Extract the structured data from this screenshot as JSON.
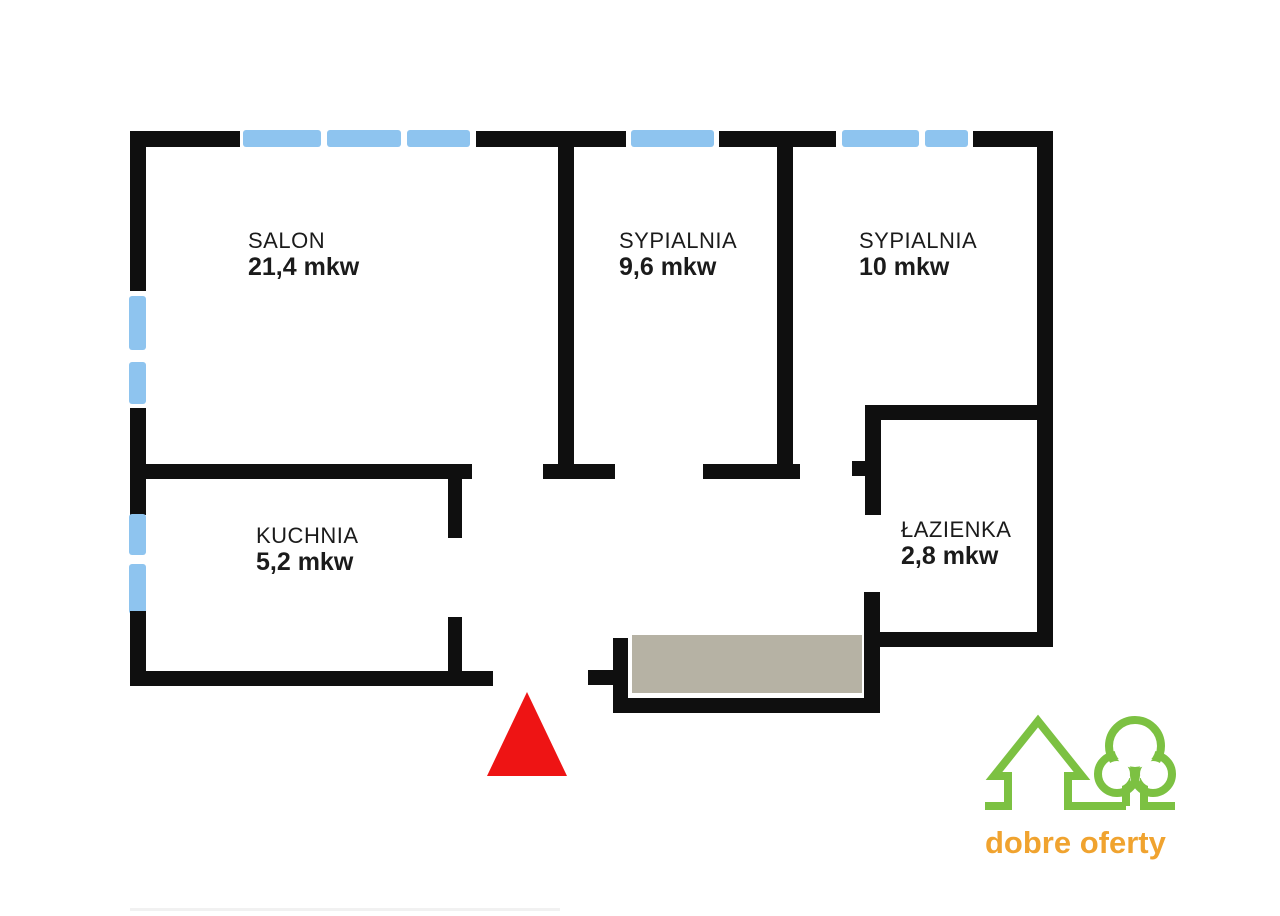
{
  "plan": {
    "rooms": [
      {
        "name": "SALON",
        "area": "21,4 mkw"
      },
      {
        "name": "SYPIALNIA",
        "area": "9,6 mkw"
      },
      {
        "name": "SYPIALNIA",
        "area": "10 mkw"
      },
      {
        "name": "KUCHNIA",
        "area": "5,2 mkw"
      },
      {
        "name": "ŁAZIENKA",
        "area": "2,8 mkw"
      }
    ],
    "colors": {
      "wall": "#0f0f0f",
      "window": "#8ec4ef",
      "balcony_floor": "#b6b2a4",
      "entrance_arrow": "#ee1414",
      "logo_green": "#7cc142",
      "logo_orange": "#f0a32f"
    }
  },
  "logo": {
    "text": "dobre oferty"
  }
}
